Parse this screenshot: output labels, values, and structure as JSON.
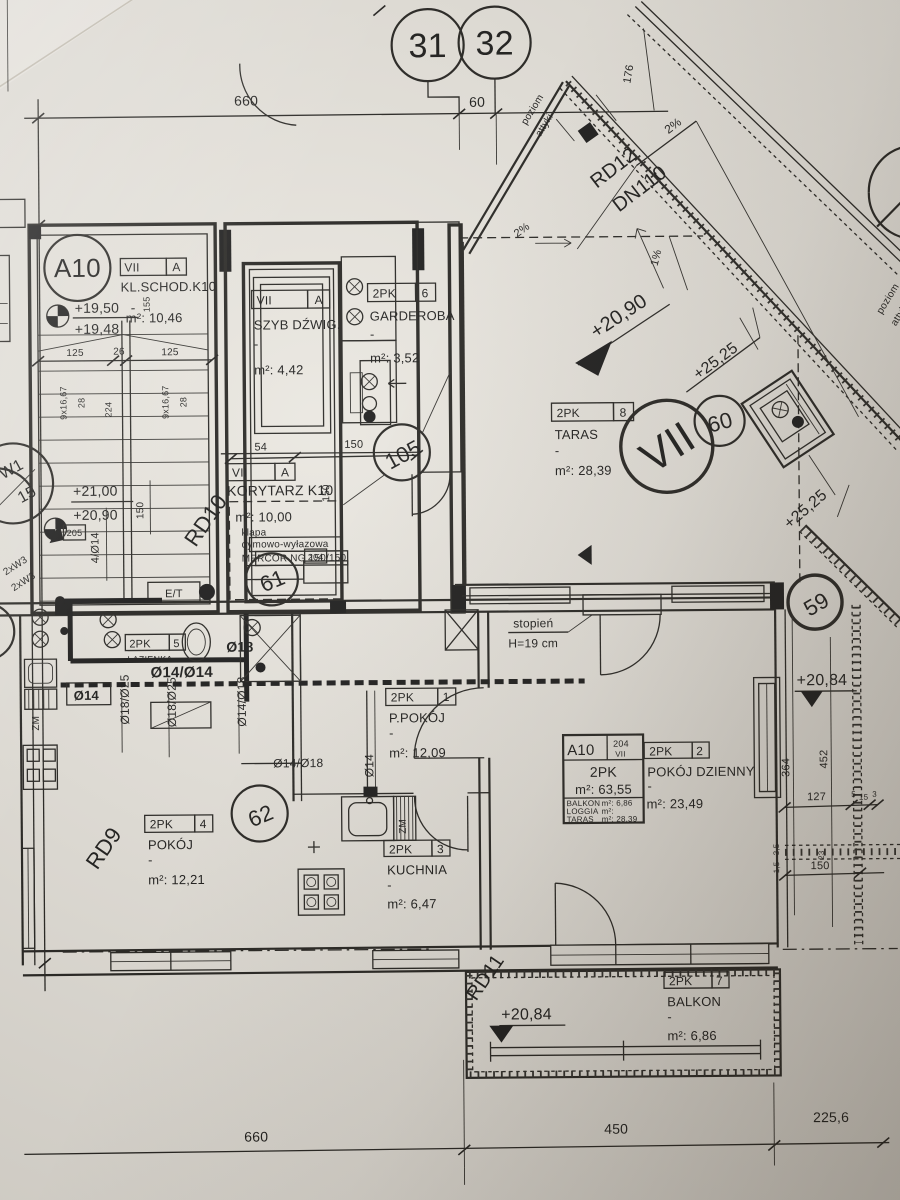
{
  "photo": {
    "paper": "#e9e6df",
    "ink": "#1c1b19"
  },
  "markers": {
    "m31": "31",
    "m32": "32",
    "m105": "105",
    "m61": "61",
    "m62": "62",
    "m59": "59",
    "m60": "60",
    "mVII": "VII",
    "mA10": "A10",
    "mW1": "W1",
    "mW1n": "15"
  },
  "levels": {
    "l1950": "+19,50",
    "l1948": "+19,48",
    "l2100": "+21,00",
    "l2090": "+20,90",
    "t2090": "+20,90",
    "t2525a": "+25,25",
    "t2525b": "+25,25",
    "r2084": "+20,84",
    "b2084": "+20,84"
  },
  "rooms": {
    "schody": {
      "f": "VII",
      "z": "A",
      "name": "KL.SCHOD.K10",
      "area": "m²: 10,46"
    },
    "szyb": {
      "f": "VII",
      "z": "A",
      "name": "SZYB DŹWIG.",
      "area": "m²: 4,42"
    },
    "garderoba": {
      "f": "2PK",
      "z": "6",
      "name": "GARDEROBA",
      "area": "m²: 3,52"
    },
    "korytarz": {
      "f": "VII",
      "z": "A",
      "name": "KORYTARZ K10",
      "area": "m²: 10,00"
    },
    "taras": {
      "f": "2PK",
      "z": "8",
      "name": "TARAS",
      "area": "m²: 28,39"
    },
    "lazienka": {
      "f": "2PK",
      "z": "5",
      "name": "ŁAZIENKA"
    },
    "ppokoj": {
      "f": "2PK",
      "z": "1",
      "name": "P.POKÓJ",
      "area": "m²: 12,09"
    },
    "dzienny": {
      "f": "2PK",
      "z": "2",
      "name": "POKÓJ DZIENNY",
      "area": "m²: 23,49"
    },
    "pokoj": {
      "f": "2PK",
      "z": "4",
      "name": "POKÓJ",
      "area": "m²: 12,21"
    },
    "kuchnia": {
      "f": "2PK",
      "z": "3",
      "name": "KUCHNIA",
      "area": "m²: 6,47"
    },
    "balkon": {
      "f": "2PK",
      "z": "7",
      "name": "BALKON",
      "area": "m²: 6,86"
    }
  },
  "apt_table": {
    "id": "A10",
    "unit": "204",
    "floor": "VII",
    "type": "2PK",
    "area": "m²: 63,55",
    "r1k": "BALKON",
    "r1v": "m²:  6,86",
    "r2k": "LOGGIA",
    "r2v": "m²:",
    "r3k": "TARAS",
    "r3v": "m²:  28,39"
  },
  "annotations": {
    "poziom1a": "poziom",
    "poziom1b": "attyki",
    "poziom2a": "poziom",
    "poziom2b": "attyki",
    "rd9": "RD9",
    "rd10": "RD10",
    "rd11": "RD11",
    "rd12": "RD12",
    "dn110": "DN110",
    "s2a": "2%",
    "s2b": "2%",
    "s1": "1%",
    "stopien": "stopień",
    "stopienH": "H=19 cm",
    "klapa1": "klapa",
    "klapa2": "dymowo-wyłazowa",
    "klapa3": "MERCOR NG 150/150",
    "n204": "204",
    "n205": "205",
    "et": "E/T",
    "zm1": "ZM",
    "zm2": "ZM",
    "w2a": "2xW3",
    "w2b": "2xW3"
  },
  "pipes": {
    "p1414": "Ø14/Ø14",
    "p18": "Ø18",
    "p14": "Ø14",
    "p1825a": "Ø18/Ø25",
    "p1825b": "Ø18/Ø25",
    "p1418a": "Ø14/Ø18",
    "p1418b": "Ø14/Ø18",
    "p414": "4/Ø14",
    "p14v": "Ø14"
  },
  "dims": {
    "top660": "660",
    "top60": "60",
    "b660": "660",
    "b450": "450",
    "b2256": "225,6",
    "s125a": "125",
    "s26": "26",
    "s125b": "125",
    "s155": "155",
    "s9xa": "9x16,67",
    "s28a": "28",
    "s224": "224",
    "s9xb": "9x16,67",
    "s28b": "28",
    "k54": "54",
    "k150a": "150",
    "k150v": "150",
    "l150": "150",
    "r364": "364",
    "r452": "452",
    "r127": "127",
    "r5": "5",
    "r15": "15",
    "r3": "3",
    "r23": "23",
    "r150": "150",
    "r35": "3,5",
    "r15b": "1,5",
    "t176": "176"
  },
  "misc": {
    "dash": "-"
  }
}
